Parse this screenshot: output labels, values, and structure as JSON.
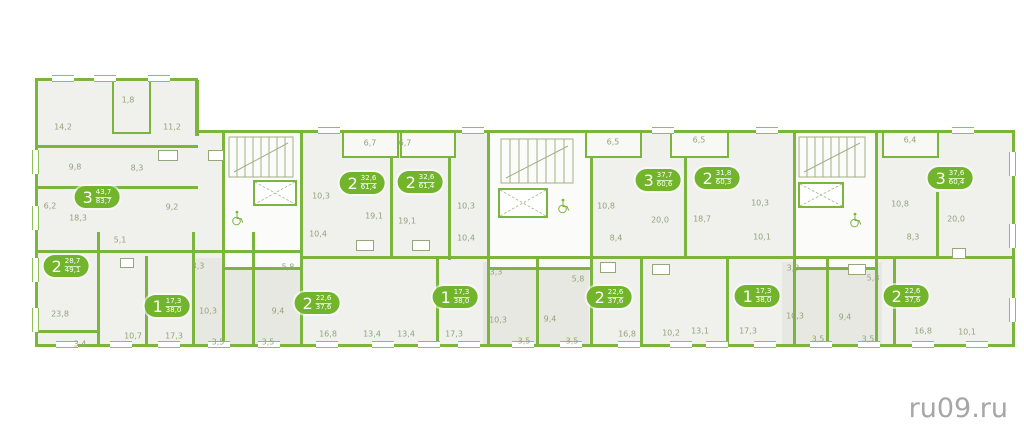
{
  "watermark": "ru09.ru",
  "colors": {
    "wall_green": "#7cb53e",
    "badge_green": "#72b42c",
    "room_fill": "#f0f0ec",
    "label_olive": "#95a37c",
    "watermark_gray": "#a6a6a6"
  },
  "apartments": [
    {
      "rooms": "3",
      "area_top": "43,7",
      "area_bottom": "83,7",
      "x": 97,
      "y": 197
    },
    {
      "rooms": "2",
      "area_top": "28,7",
      "area_bottom": "49,1",
      "x": 66,
      "y": 266
    },
    {
      "rooms": "1",
      "area_top": "17,3",
      "area_bottom": "38,0",
      "x": 167,
      "y": 306
    },
    {
      "rooms": "2",
      "area_top": "22,6",
      "area_bottom": "37,6",
      "x": 317,
      "y": 303
    },
    {
      "rooms": "2",
      "area_top": "32,6",
      "area_bottom": "61,4",
      "x": 362,
      "y": 183
    },
    {
      "rooms": "2",
      "area_top": "32,6",
      "area_bottom": "61,4",
      "x": 420,
      "y": 182
    },
    {
      "rooms": "1",
      "area_top": "17,3",
      "area_bottom": "38,0",
      "x": 455,
      "y": 297
    },
    {
      "rooms": "2",
      "area_top": "22,6",
      "area_bottom": "37,6",
      "x": 609,
      "y": 297
    },
    {
      "rooms": "3",
      "area_top": "37,7",
      "area_bottom": "60,6",
      "x": 658,
      "y": 180
    },
    {
      "rooms": "2",
      "area_top": "31,8",
      "area_bottom": "60,3",
      "x": 717,
      "y": 178
    },
    {
      "rooms": "1",
      "area_top": "17,3",
      "area_bottom": "38,0",
      "x": 757,
      "y": 296
    },
    {
      "rooms": "2",
      "area_top": "22,6",
      "area_bottom": "37,6",
      "x": 906,
      "y": 296
    },
    {
      "rooms": "3",
      "area_top": "37,6",
      "area_bottom": "60,4",
      "x": 950,
      "y": 178
    }
  ],
  "room_labels": [
    {
      "text": "1,8",
      "x": 128,
      "y": 100
    },
    {
      "text": "14,2",
      "x": 63,
      "y": 127
    },
    {
      "text": "11,2",
      "x": 172,
      "y": 127
    },
    {
      "text": "9,8",
      "x": 75,
      "y": 167
    },
    {
      "text": "8,3",
      "x": 137,
      "y": 168
    },
    {
      "text": "6,2",
      "x": 50,
      "y": 206
    },
    {
      "text": "18,3",
      "x": 78,
      "y": 218
    },
    {
      "text": "9,2",
      "x": 172,
      "y": 207
    },
    {
      "text": "5,1",
      "x": 120,
      "y": 240
    },
    {
      "text": "23,8",
      "x": 60,
      "y": 314
    },
    {
      "text": "3,4",
      "x": 80,
      "y": 344
    },
    {
      "text": "10,7",
      "x": 133,
      "y": 336
    },
    {
      "text": "17,3",
      "x": 174,
      "y": 336
    },
    {
      "text": "10,3",
      "x": 208,
      "y": 311
    },
    {
      "text": "3,5",
      "x": 218,
      "y": 342
    },
    {
      "text": "9,4",
      "x": 278,
      "y": 311
    },
    {
      "text": "3,5",
      "x": 268,
      "y": 342
    },
    {
      "text": "3,3",
      "x": 198,
      "y": 266
    },
    {
      "text": "5,8",
      "x": 288,
      "y": 267
    },
    {
      "text": "10,4",
      "x": 318,
      "y": 234
    },
    {
      "text": "16,8",
      "x": 328,
      "y": 334
    },
    {
      "text": "6,7",
      "x": 370,
      "y": 143
    },
    {
      "text": "6,7",
      "x": 405,
      "y": 143
    },
    {
      "text": "10,3",
      "x": 321,
      "y": 196
    },
    {
      "text": "19,1",
      "x": 374,
      "y": 216
    },
    {
      "text": "19,1",
      "x": 407,
      "y": 221
    },
    {
      "text": "13,4",
      "x": 372,
      "y": 334
    },
    {
      "text": "13,4",
      "x": 406,
      "y": 334
    },
    {
      "text": "10,3",
      "x": 466,
      "y": 206
    },
    {
      "text": "10,4",
      "x": 466,
      "y": 238
    },
    {
      "text": "3,3",
      "x": 496,
      "y": 272
    },
    {
      "text": "17,3",
      "x": 454,
      "y": 334
    },
    {
      "text": "10,3",
      "x": 498,
      "y": 320
    },
    {
      "text": "3,5",
      "x": 524,
      "y": 341
    },
    {
      "text": "9,4",
      "x": 550,
      "y": 319
    },
    {
      "text": "3,5",
      "x": 572,
      "y": 341
    },
    {
      "text": "5,8",
      "x": 578,
      "y": 279
    },
    {
      "text": "16,8",
      "x": 627,
      "y": 334
    },
    {
      "text": "10,2",
      "x": 671,
      "y": 333
    },
    {
      "text": "13,1",
      "x": 700,
      "y": 331
    },
    {
      "text": "6,5",
      "x": 613,
      "y": 142
    },
    {
      "text": "6,5",
      "x": 699,
      "y": 140
    },
    {
      "text": "10,8",
      "x": 606,
      "y": 206
    },
    {
      "text": "20,0",
      "x": 660,
      "y": 220
    },
    {
      "text": "18,7",
      "x": 702,
      "y": 219
    },
    {
      "text": "10,3",
      "x": 760,
      "y": 203
    },
    {
      "text": "8,4",
      "x": 616,
      "y": 238
    },
    {
      "text": "10,1",
      "x": 762,
      "y": 237
    },
    {
      "text": "3,3",
      "x": 793,
      "y": 268
    },
    {
      "text": "17,3",
      "x": 748,
      "y": 331
    },
    {
      "text": "10,3",
      "x": 795,
      "y": 316
    },
    {
      "text": "3,5",
      "x": 818,
      "y": 339
    },
    {
      "text": "9,4",
      "x": 845,
      "y": 317
    },
    {
      "text": "3,5",
      "x": 868,
      "y": 339
    },
    {
      "text": "5,8",
      "x": 873,
      "y": 278
    },
    {
      "text": "16,8",
      "x": 923,
      "y": 331
    },
    {
      "text": "10,1",
      "x": 967,
      "y": 332
    },
    {
      "text": "6,4",
      "x": 910,
      "y": 140
    },
    {
      "text": "10,8",
      "x": 900,
      "y": 204
    },
    {
      "text": "20,0",
      "x": 956,
      "y": 219
    },
    {
      "text": "8,3",
      "x": 913,
      "y": 237
    }
  ]
}
